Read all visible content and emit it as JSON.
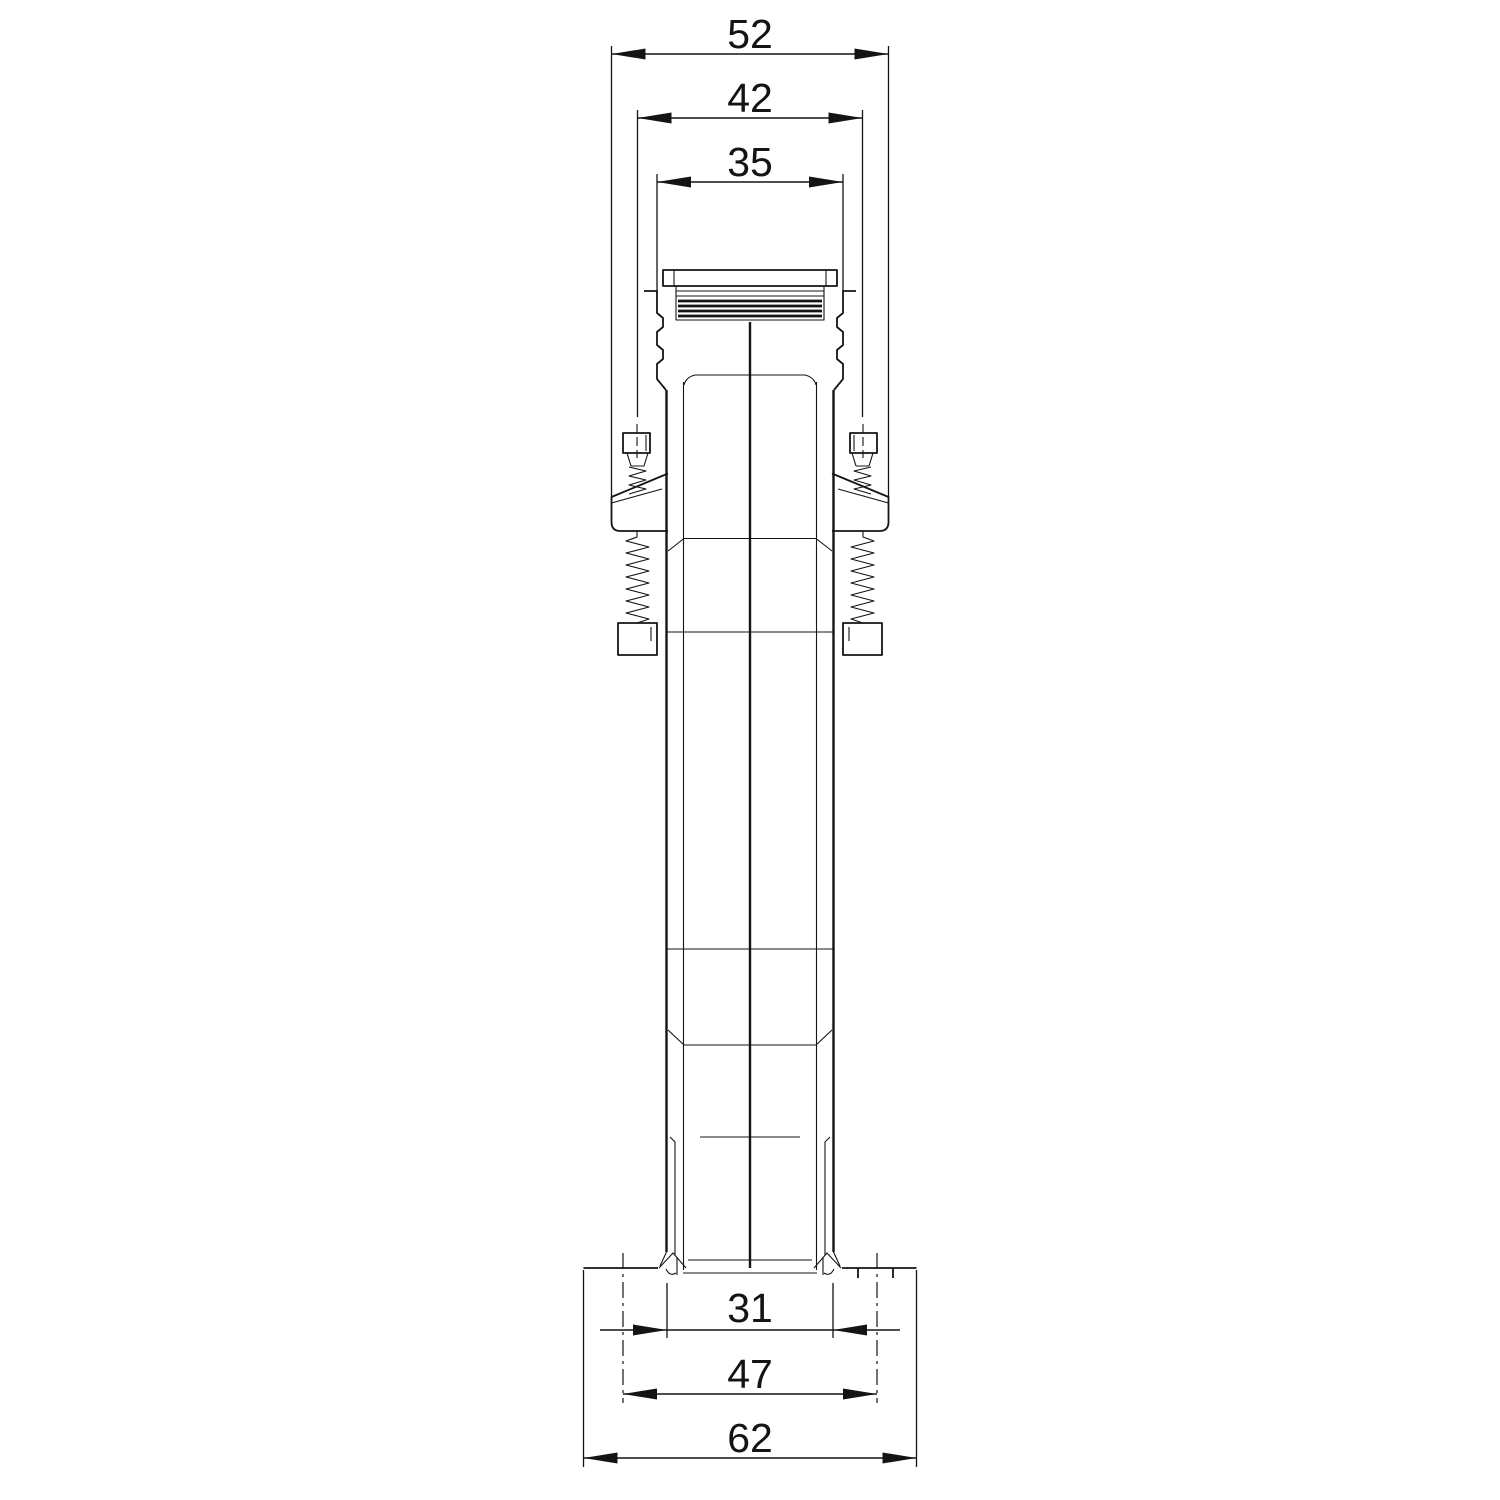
{
  "drawing": {
    "background_color": "#ffffff",
    "line_color": "#141414",
    "dimensions": {
      "top": [
        {
          "label": "52"
        },
        {
          "label": "42"
        },
        {
          "label": "35"
        }
      ],
      "bottom": [
        {
          "label": "31"
        },
        {
          "label": "47"
        },
        {
          "label": "62"
        }
      ]
    }
  }
}
